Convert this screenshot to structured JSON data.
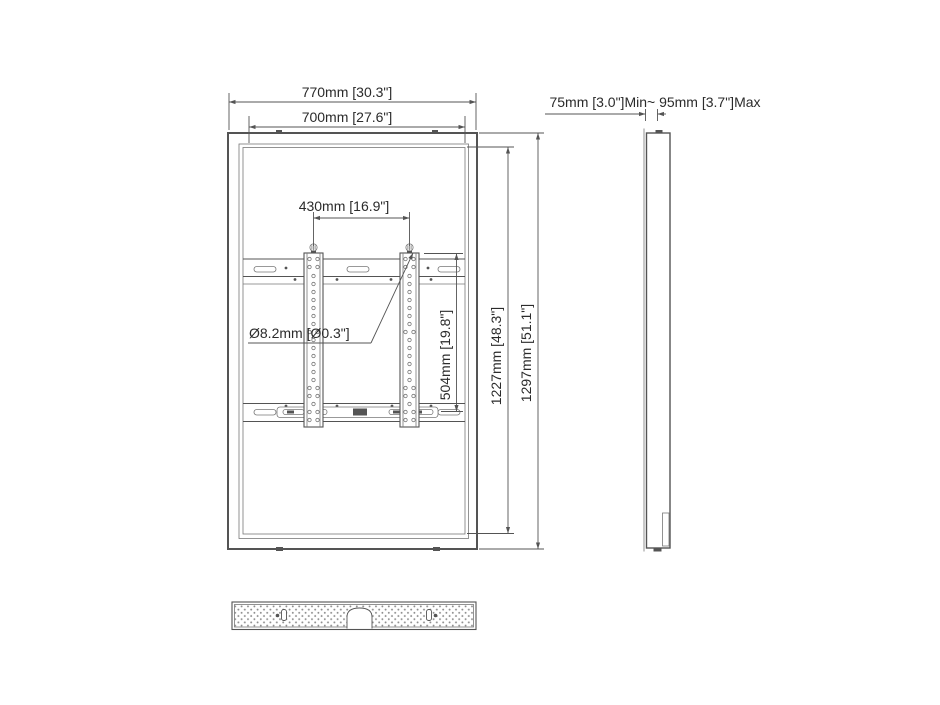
{
  "colors": {
    "line": "#545454",
    "line_light": "#787878",
    "text": "#2b2b2b",
    "background": "#ffffff",
    "perforation": "#8d8d8d"
  },
  "dimensions": {
    "outer_width": "770mm [30.3\"]",
    "inner_width": "700mm [27.6\"]",
    "bracket_spacing": "430mm [16.9\"]",
    "hole_diameter": "Ø8.2mm [Ø0.3\"]",
    "bracket_height": "504mm [19.8\"]",
    "inner_height": "1227mm [48.3\"]",
    "outer_height": "1297mm [51.1\"]",
    "depth_range": "75mm [3.0\"]Min~ 95mm [3.7\"]Max"
  }
}
